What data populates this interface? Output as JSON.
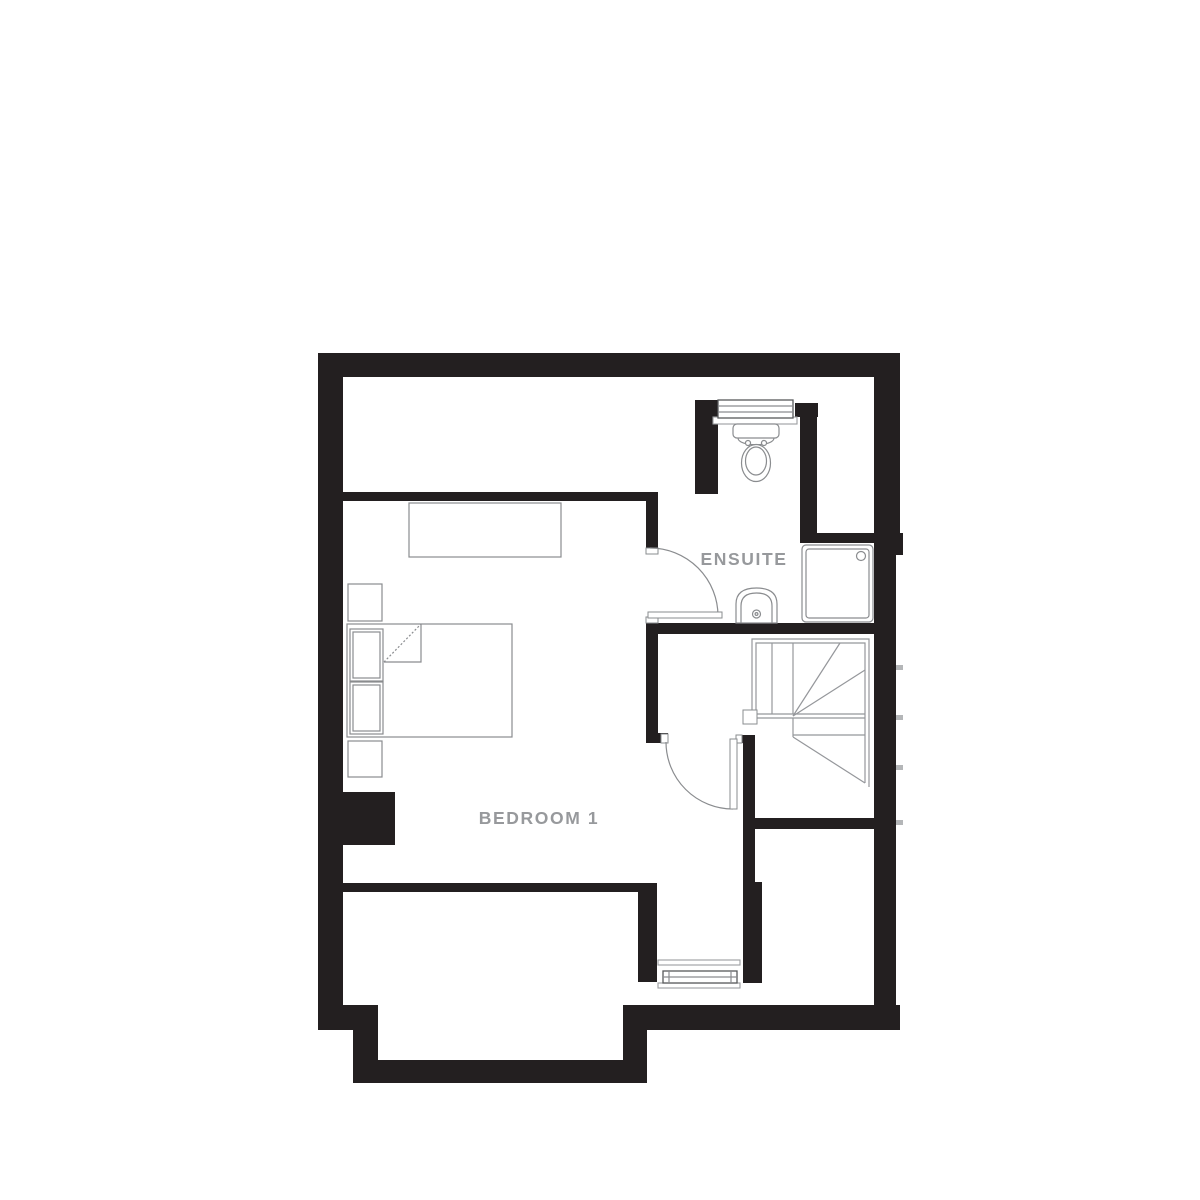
{
  "plan": {
    "type": "floor-plan",
    "rooms": [
      {
        "name": "bedroom-1",
        "label": "BEDROOM 1"
      },
      {
        "name": "ensuite",
        "label": "ENSUITE"
      }
    ],
    "fixtures": [
      "double-bed",
      "headboard-cushions",
      "bedside-table-upper",
      "bedside-table-lower",
      "wardrobe",
      "chimney-breast",
      "toilet",
      "pedestal-basin",
      "shower-tray",
      "winder-staircase",
      "newel-post",
      "ensuite-window",
      "bedroom-bay-window",
      "ensuite-door",
      "bedroom-door"
    ],
    "palette": {
      "wall": "#231f20",
      "fixture_outline": "#8a8c8f",
      "stair_outline": "#95979b",
      "window_frame": "#58595b",
      "label_text": "#97999c",
      "background": "#ffffff"
    }
  }
}
